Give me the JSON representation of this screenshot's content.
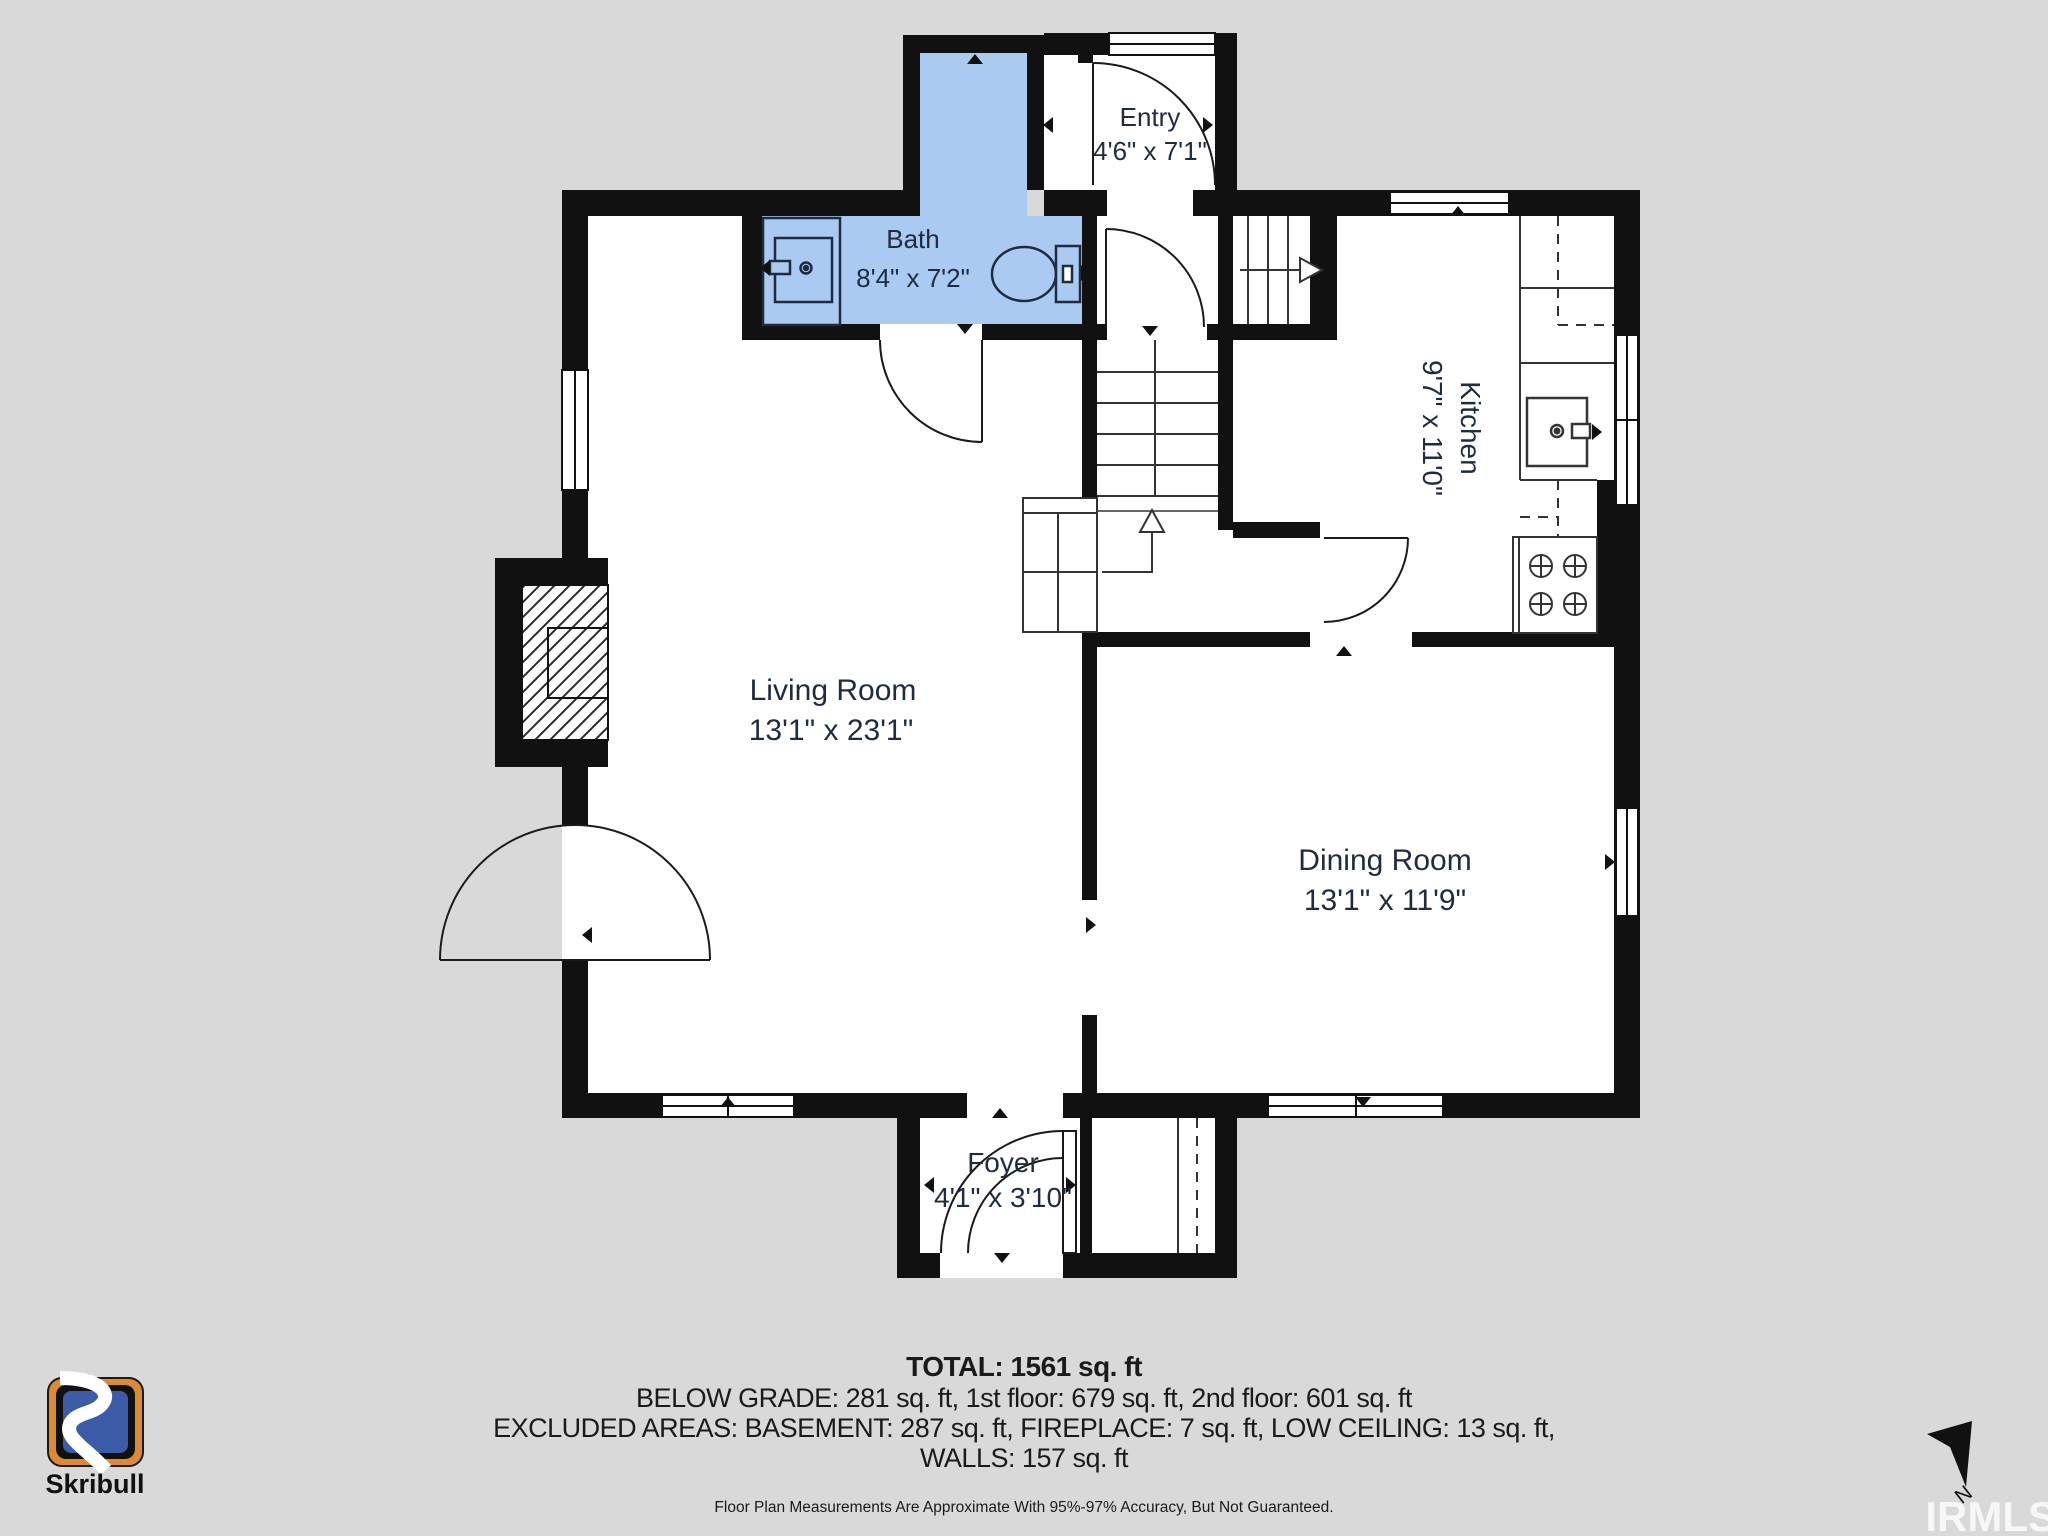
{
  "rooms": {
    "bath": {
      "name": "Bath",
      "dims": "8'4\" x 7'2\""
    },
    "entry": {
      "name": "Entry",
      "dims": "4'6\" x 7'1\""
    },
    "kitchen": {
      "name": "Kitchen",
      "dims": "9'7\" x 11'0\""
    },
    "living": {
      "name": "Living Room",
      "dims": "13'1\" x 23'1\""
    },
    "dining": {
      "name": "Dining Room",
      "dims": "13'1\" x 11'9\""
    },
    "foyer": {
      "name": "Foyer",
      "dims": "4'1\" x 3'10\""
    }
  },
  "summary": {
    "total": "TOTAL: 1561 sq. ft",
    "line1": "BELOW GRADE: 281 sq. ft, 1st floor: 679 sq. ft, 2nd floor: 601 sq. ft",
    "line2": "EXCLUDED AREAS: BASEMENT: 287 sq. ft, FIREPLACE: 7 sq. ft, LOW CEILING: 13 sq. ft,",
    "line3": "WALLS: 157 sq. ft",
    "disclaimer": "Floor Plan Measurements Are Approximate With 95%-97% Accuracy, But Not Guaranteed."
  },
  "branding": {
    "logo_text": "Skribull"
  },
  "compass": {
    "north_label": "N"
  },
  "watermark": "IRMLS",
  "colors": {
    "background": "#d9d9d9",
    "wall": "#111111",
    "bath_fill": "#aacaf2",
    "room_text": "#1f2b3e",
    "summary_text": "#1a1a1a",
    "logo_orange": "#dd8a35",
    "logo_blue": "#3d5ca8"
  }
}
